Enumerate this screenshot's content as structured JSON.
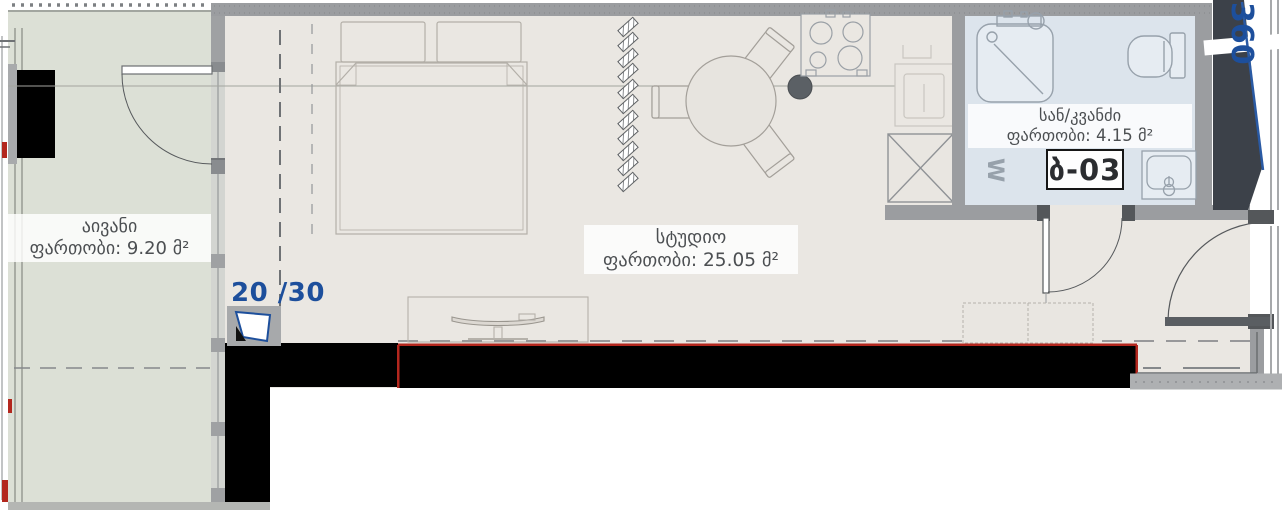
{
  "rooms": {
    "balcony": {
      "name": "აივანი",
      "area_label": "ფართობი: 9.20 მ²"
    },
    "studio": {
      "name": "სტუდიო",
      "area_label": "ფართობი: 25.05 მ²"
    },
    "bathroom": {
      "name": "სან/კვანძი",
      "area_label": "ფართობი: 4.15 მ²"
    }
  },
  "labels": {
    "unit_number": "ბ-03",
    "window_ratio": "20 /30",
    "axis_number": "360",
    "washer_symbol": "W"
  },
  "colors": {
    "balcony_fill": "#dce0d6",
    "floor_fill": "#eae7e2",
    "bathroom_fill": "#dce4ec",
    "wall_gray": "#9b9da0",
    "dark_wall": "#3c4149",
    "black_wall": "#000000",
    "accent_red": "#b3271e",
    "accent_blue": "#1d4f9c",
    "label_text": "#4c4f52"
  }
}
